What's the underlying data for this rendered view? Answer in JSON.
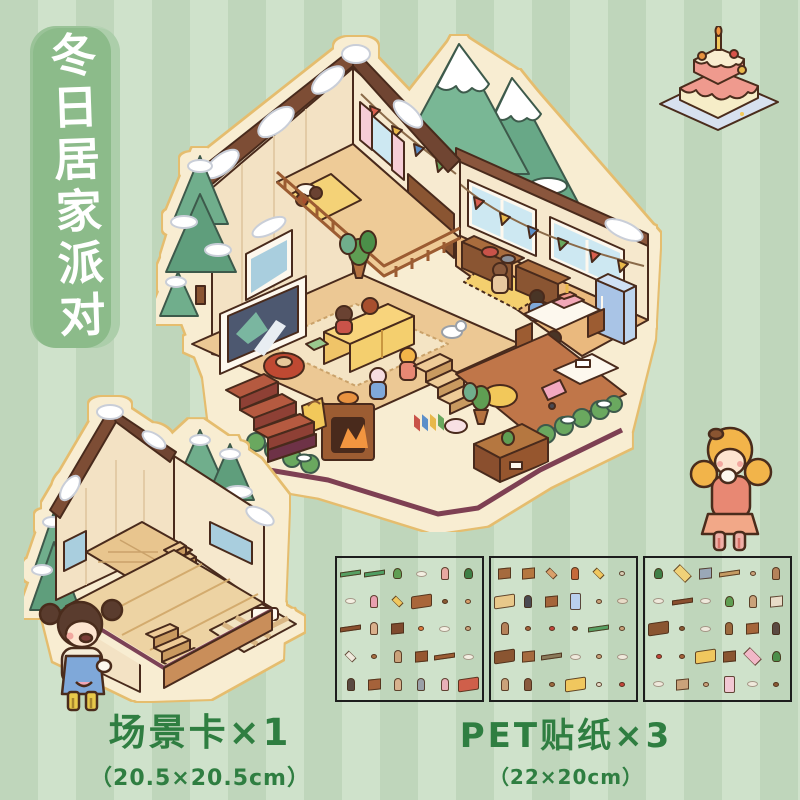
{
  "banner": {
    "text": "冬日居家派对",
    "bg_color": "#8cbb8a",
    "text_color": "#ffffff"
  },
  "labels": {
    "scene_card": {
      "label": "场景卡×1",
      "size": "（20.5×20.5cm）"
    },
    "pet_sticker": {
      "label": "PET贴纸×3",
      "size": "（22×20cm）"
    }
  },
  "colors": {
    "stripe_light": "#cfe2cb",
    "stripe_dark": "#bfd6bb",
    "banner_green": "#8cbb8a",
    "label_green": "#2f7e41",
    "sticker_halo_cream": "#f8edd2",
    "sticker_halo_gold": "#e5bd6e",
    "roof_brown": "#7d4e36",
    "wall_cream": "#f3e2c4",
    "floor_wood": "#ecc894",
    "sofa_yellow": "#f0c468",
    "tree_green": "#6fae8c",
    "trim_maroon": "#7e4053"
  },
  "decorations": {
    "main_scene": "winter-house-party-scene",
    "empty_scene": "empty-scene-card",
    "cake": "birthday-cake-icon",
    "girl_right": "girl-drinking-character",
    "girl_left": "girl-laughing-character"
  },
  "sticker_sheets": [
    {
      "items": [
        "long|#57a063",
        "long|#4f9e63",
        "plant|#5f9e52",
        "blob|#f3efe2",
        "chr|#e8a8a0",
        "plant|#3f7f46",
        "blob|#f3efe2",
        "chr|#e8a0b0",
        "rug|#f0c75e",
        "big|#a9663a",
        "dot|#8a5a33",
        "dot|#d9a06a",
        "long|#8a4f2e",
        "chr|#d9b08c",
        "box|#7e4a2d",
        "dot|#e07b3f",
        "blob|#f3efe2",
        "dot|#caa27a",
        "rug|#efe9dc",
        "dot|#a86f43",
        "chr|#caa27a",
        "box|#96562f",
        "long|#9c5c33",
        "blob|#f3efe2",
        "chr|#5a4a42",
        "box|#a5623a",
        "chr|#d8b28e",
        "chr|#9aa0a8",
        "chr|#e8b0b8",
        "big|#cf5f4a"
      ]
    },
    {
      "items": [
        "box|#a56a3e",
        "box|#b5773f",
        "rug|#d9a06a",
        "chr|#c56a3a",
        "rug|#f0c75e",
        "dot|#d9cdb4",
        "big|#e8c88a",
        "chr|#4a4a52",
        "box|#a5653a",
        "tall|#b9d0ee",
        "dot|#caa27a",
        "blob|#e8dcc8",
        "chr|#b5825a",
        "dot|#a5623a",
        "dot|#c4453a",
        "dot|#8a5a33",
        "long|#57a063",
        "dot|#caa27a",
        "big|#8a5531",
        "box|#a56a3e",
        "long|#8a7a5a",
        "blob|#efe9dc",
        "dot|#caa27a",
        "blob|#efe9dc",
        "chr|#caa27a",
        "chr|#8a5a3e",
        "dot|#9c6a3f",
        "big|#f0c75e",
        "dot|#e8dcc8",
        "dot|#c4453a"
      ]
    },
    {
      "items": [
        "plant|#3f7f46",
        "bigrug|#f0d178",
        "box|#9aa8b8",
        "long|#c49a62",
        "dot|#caa27a",
        "chr|#b5825a",
        "blob|#efe9dc",
        "long|#8a4f2e",
        "blob|#efe9dc",
        "plant|#5f9e52",
        "chr|#caa27a",
        "box|#e8dcc8",
        "big|#8a5531",
        "dot|#8a5a33",
        "blob|#efe9dc",
        "chr|#9c6a3f",
        "box|#a5653a",
        "chr|#5a4a42",
        "dot|#c4453a",
        "dot|#a5623a",
        "big|#f0c75e",
        "box|#8a5531",
        "bigrug|#f2b8c8",
        "plant|#4c8f4a",
        "blob|#efe9dc",
        "box|#caa27a",
        "dot|#caa27a",
        "tall|#f2c8d4",
        "blob|#efe9dc",
        "dot|#8a5a33"
      ]
    }
  ]
}
